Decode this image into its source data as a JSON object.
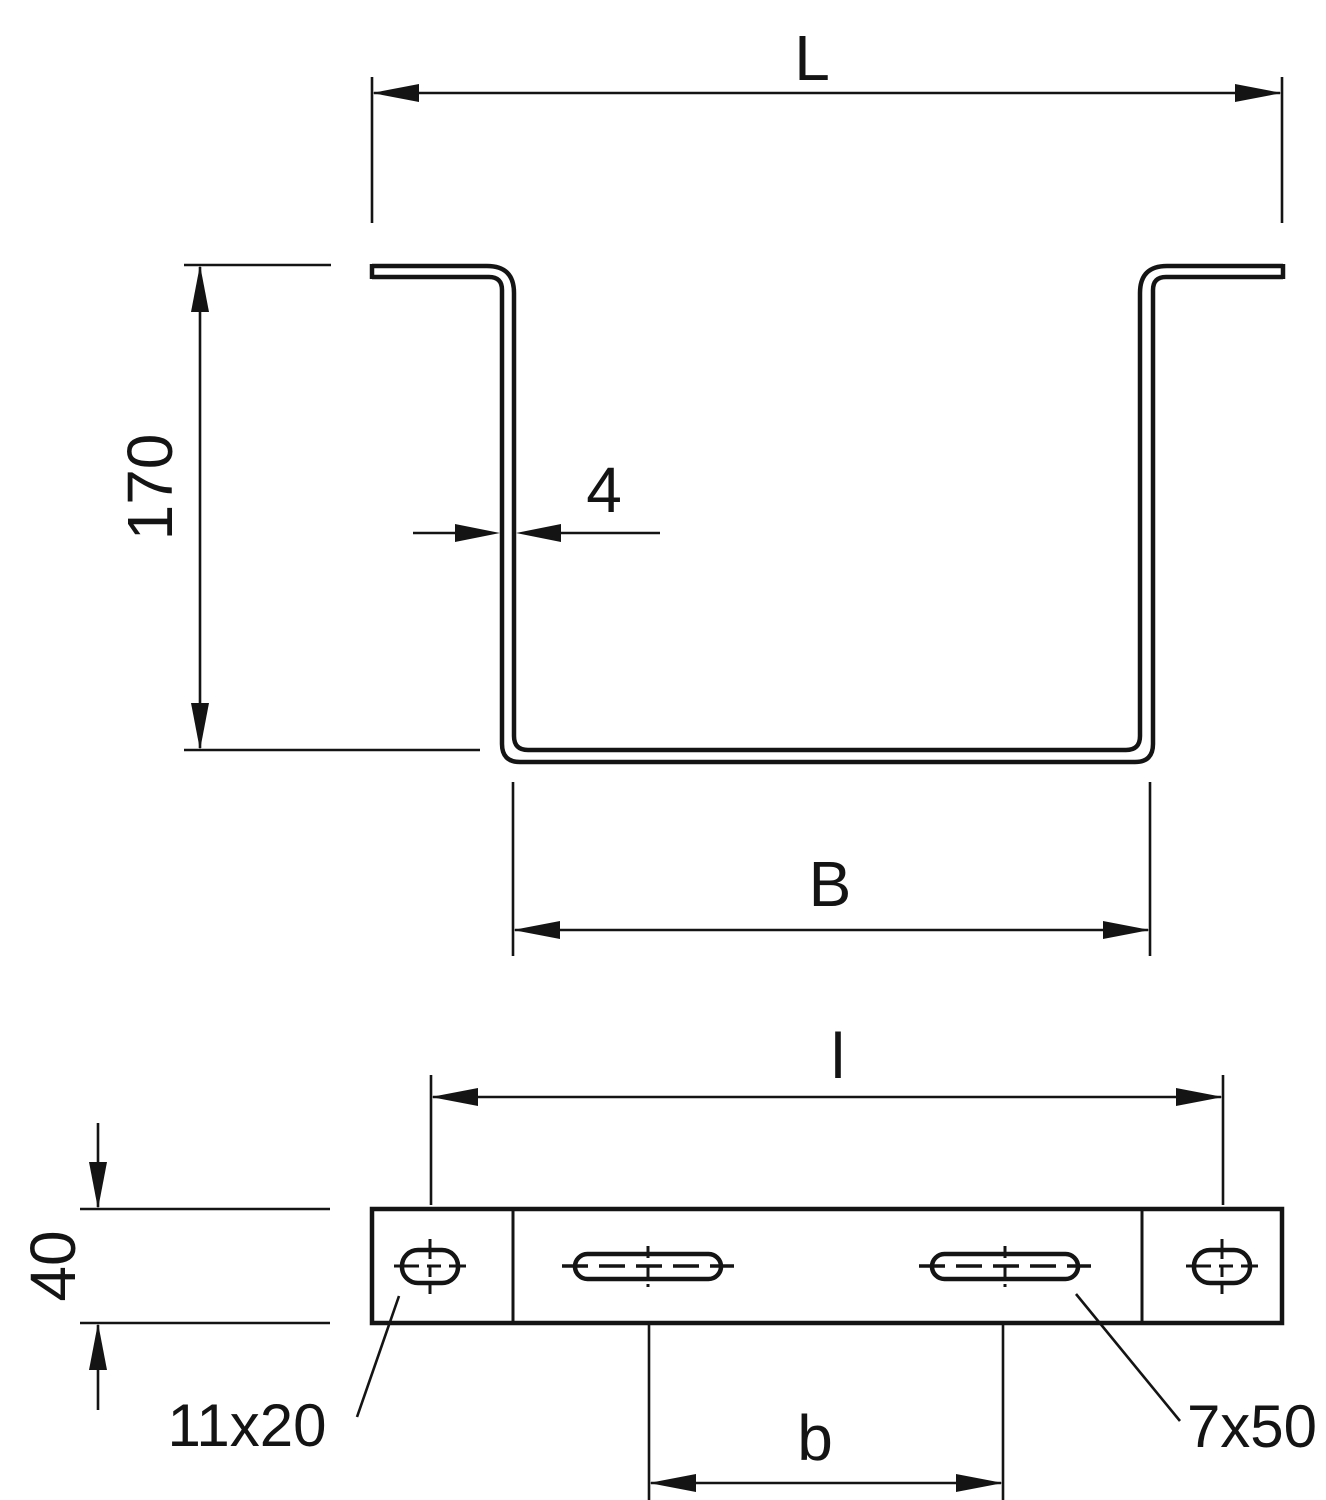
{
  "drawing": {
    "kind": "technical-drawing",
    "ink_color": "#141414",
    "background_color": "#ffffff"
  },
  "profile_view": {
    "dim_length_label": "L",
    "dim_height_label": "170",
    "dim_thickness_label": "4",
    "dim_inner_width_label": "B"
  },
  "plate_view": {
    "dim_hole_spacing_label": "l",
    "dim_plate_width_label": "40",
    "dim_slot_spacing_label": "b",
    "end_hole_size_label": "11x20",
    "slot_size_label": "7x50"
  }
}
